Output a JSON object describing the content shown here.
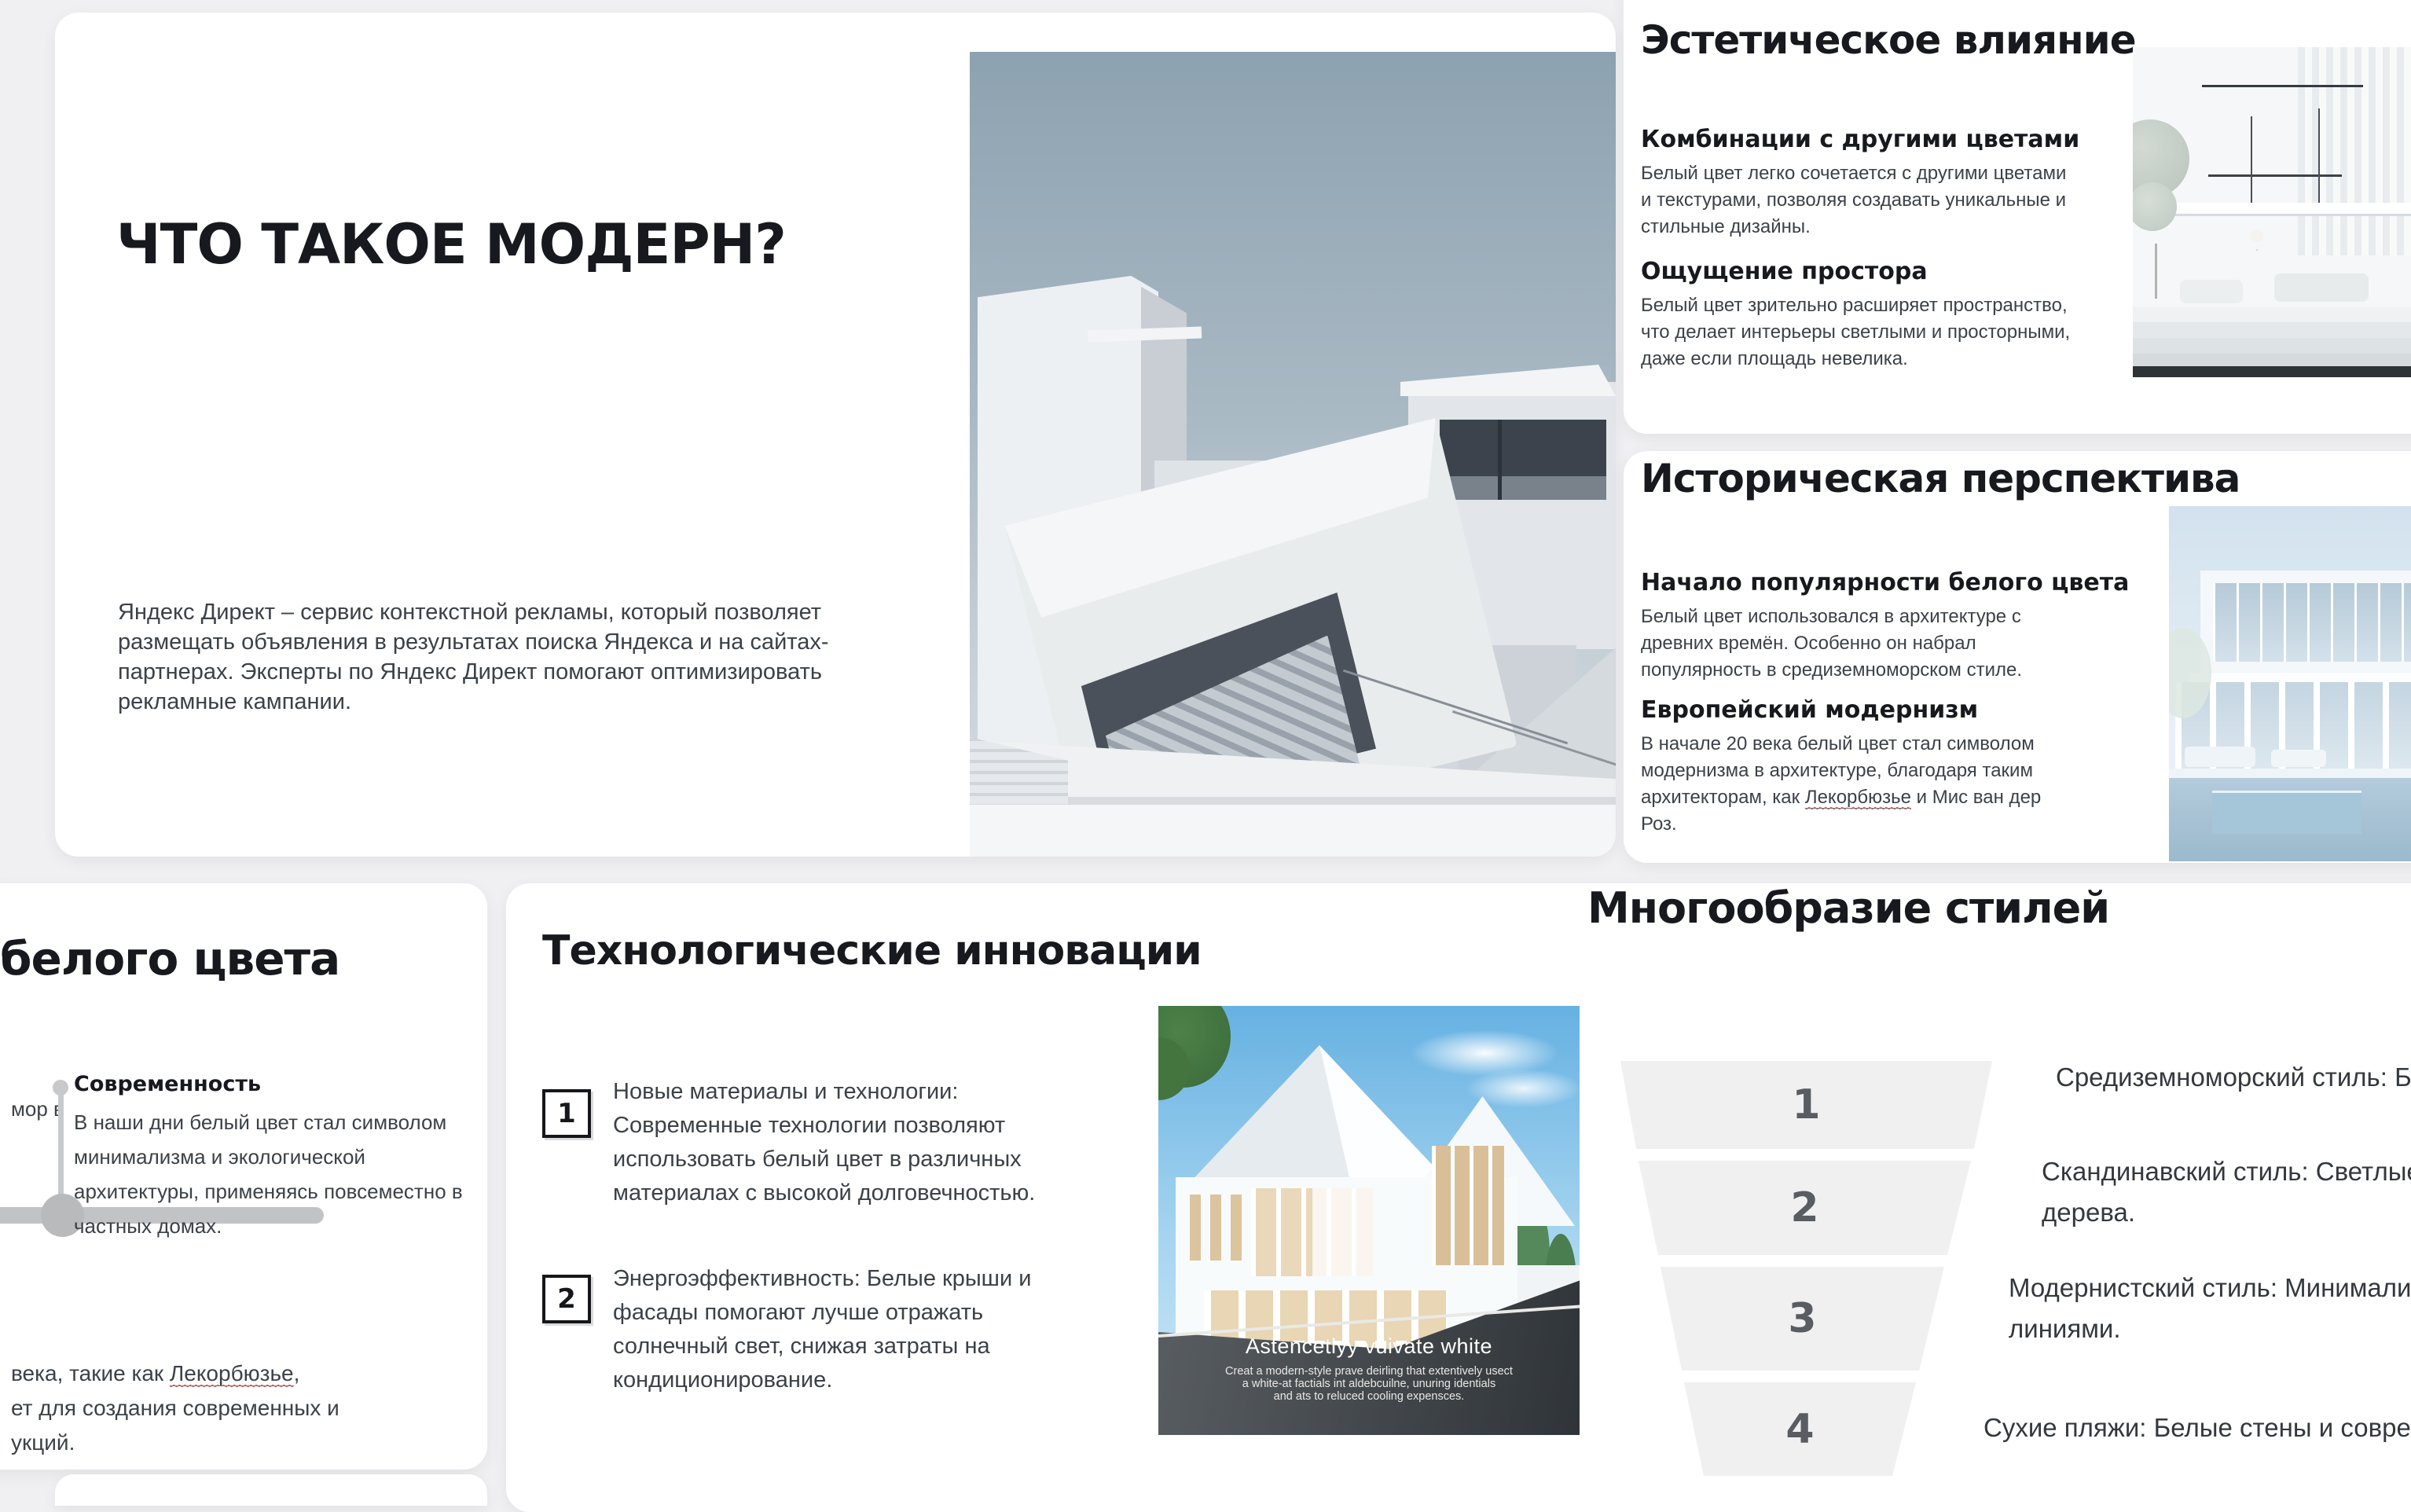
{
  "colors": {
    "page_bg": "#f0f0f2",
    "card_bg": "#ffffff",
    "heading": "#17191e",
    "body_text": "#3c4148",
    "funnel_fill": "#f0f0f1",
    "funnel_number": "#595d62",
    "timeline_gray": "#c2c3c5",
    "spellcheck_red": "#cf6057"
  },
  "slide_modern": {
    "title": "ЧТО ТАКОЕ МОДЕРН?",
    "body": "Яндекс Директ – сервис контекстной рекламы, который позволяет размещать объявления в результатах поиска Яндекса и на сайтах-партнерах. Эксперты по Яндекс Директ помогают оптимизировать рекламные кампании."
  },
  "slide_aesthetic": {
    "title": "Эстетическое влияние",
    "sections": [
      {
        "heading": "Комбинации с другими цветами",
        "body": "Белый цвет легко сочетается с другими цветами и текстурами, позволяя создавать уникальные и стильные дизайны."
      },
      {
        "heading": "Ощущение простора",
        "body": "Белый цвет зрительно расширяет пространство, что делает интерьеры светлыми и просторными, даже если площадь невелика."
      }
    ]
  },
  "slide_history": {
    "title": "Историческая перспектива",
    "sections": [
      {
        "heading": "Начало популярности белого цвета",
        "body": "Белый цвет использовался в архитектуре с древних времён. Особенно он набрал популярность в средиземноморском стиле."
      },
      {
        "heading": "Европейский модернизм",
        "body_pre": "В начале 20 века белый цвет стал символом модернизма в архитектуре, благодаря таким архитекторам, как ",
        "body_link": "Лекорбюзье",
        "body_post": " и Мис ван дер Роз."
      }
    ]
  },
  "slide_timeline": {
    "title_fragment": "белого цвета",
    "left_fragment": "мор в",
    "milestone": {
      "heading": "Современность",
      "body": "В наши дни белый цвет стал символом минимализма и экологической архитектуры, применяясь повсеместно в частных домах."
    },
    "bottom_lines": {
      "line1_pre": "века, такие как ",
      "line1_link": "Лекорбюзье",
      "line1_post": ",",
      "line2": "ет для создания современных и",
      "line3": "укций."
    }
  },
  "slide_tech": {
    "title": "Технологические инновации",
    "items": [
      {
        "num": "1",
        "text": "Новые материалы и технологии: Современные технологии позволяют использовать белый цвет в различных материалах с высокой долговечностью."
      },
      {
        "num": "2",
        "text": "Энергоэффективность: Белые крыши и фасады помогают лучше отражать солнечный свет, снижая затраты на кондиционирование."
      }
    ],
    "image_caption": {
      "title": "Astencetlyy vuivate white",
      "line1": "Creat a modern-style prave deirling  that extentively usect",
      "line2": "a white-at factials int aldebcuilne, unuring identials",
      "line3": "and ats to reluced cooling expensces."
    }
  },
  "slide_styles": {
    "title": "Многообразие стилей",
    "funnel": [
      {
        "num": "1",
        "line1": "Средиземноморский стиль: Белые стены и",
        "line2": ""
      },
      {
        "num": "2",
        "line1": "Скандинавский стиль: Светлые интерьеры и э",
        "line2": "дерева."
      },
      {
        "num": "3",
        "line1": "Модернистский стиль: Минималистичные бель",
        "line2": "линиями."
      },
      {
        "num": "4",
        "line1": "Сухие пляжи: Белые стены и современная просто",
        "line2": ""
      }
    ]
  }
}
